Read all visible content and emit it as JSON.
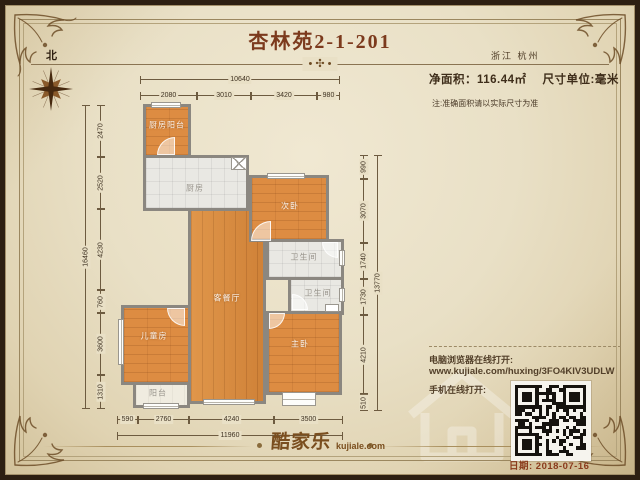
{
  "header": {
    "title": "杏林苑2-1-201",
    "location": "浙江 杭州"
  },
  "info": {
    "area_label": "净面积：116.44㎡",
    "unit_label": "尺寸单位:毫米",
    "note": "注:准确面积请以实际尺寸为准"
  },
  "compass": {
    "north_label": "北"
  },
  "decor": {
    "divider_ornament": "• ✣ •"
  },
  "rooms": {
    "kitchen_balcony": "厨房阳台",
    "kitchen": "厨房",
    "secondary_bedroom": "次卧",
    "bathroom_upper": "卫生间",
    "bathroom_lower": "卫生间",
    "living_dining": "客餐厅",
    "kids_room": "儿童房",
    "master_bedroom": "主卧",
    "balcony": "阳台"
  },
  "dimensions": {
    "top_total": "10640",
    "top_segments": [
      "2080",
      "3010",
      "3420",
      "980"
    ],
    "left_total": "16460",
    "left_segments": [
      "2470",
      "2520",
      "4230",
      "760",
      "3600",
      "1310"
    ],
    "right_total": "13770",
    "right_segments": [
      "990",
      "3070",
      "1740",
      "1730",
      "4210",
      "510"
    ],
    "bottom_total": "11960",
    "bottom_segments": [
      "590",
      "2760",
      "4240",
      "3500"
    ]
  },
  "share": {
    "pc_label": "电脑浏览器在线打开:",
    "url": "www.kujiale.com/huxing/3FO4KIV3UDLW",
    "mobile_label": "手机在线打开:",
    "date": "日期: 2018-07-16"
  },
  "footer": {
    "brand_cn": "酷家乐",
    "brand_en": "kujiale.com"
  },
  "colors": {
    "parchment": "#e9e0c6",
    "frame_dark_brown": "#2d1f12",
    "title_brown_red": "#7c3a1d",
    "wood_orange": "#dd8c42",
    "tile_gray": "#e9e8e3",
    "wall_gray": "#8b8780",
    "date_red_brown": "#8a3a1c"
  }
}
